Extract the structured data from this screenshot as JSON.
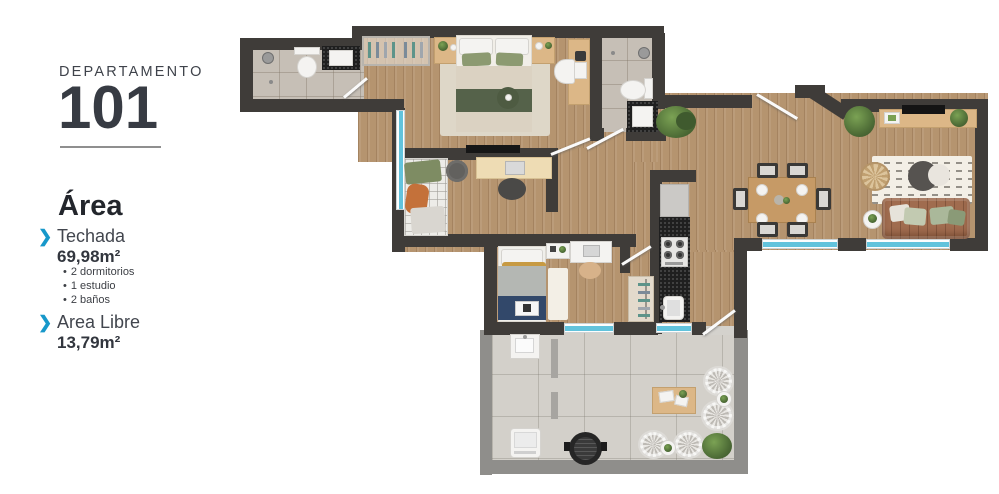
{
  "sidebar": {
    "building_label": "DEPARTAMENTO",
    "unit_number": "101",
    "area_title": "Área",
    "covered_label": "Techada",
    "covered_value": "69,98m²",
    "covered_details": [
      "2 dormitorios",
      "1 estudio",
      "2 baños"
    ],
    "free_label": "Area Libre",
    "free_value": "13,79m²"
  },
  "icons": {
    "chevron": "❯",
    "bullet": "•"
  },
  "colors": {
    "accent": "#1798ca",
    "text": "#3a3e46",
    "wall": "#3f3c39",
    "terrace_wall": "#8f8e8b",
    "wood": "#b5946f",
    "bath_tile": "#c6bfb6",
    "terrace_tile": "#d3d0ca",
    "window": "#62c3dc",
    "counter": "#1f1f1f",
    "sofa": "#a06c4f"
  }
}
